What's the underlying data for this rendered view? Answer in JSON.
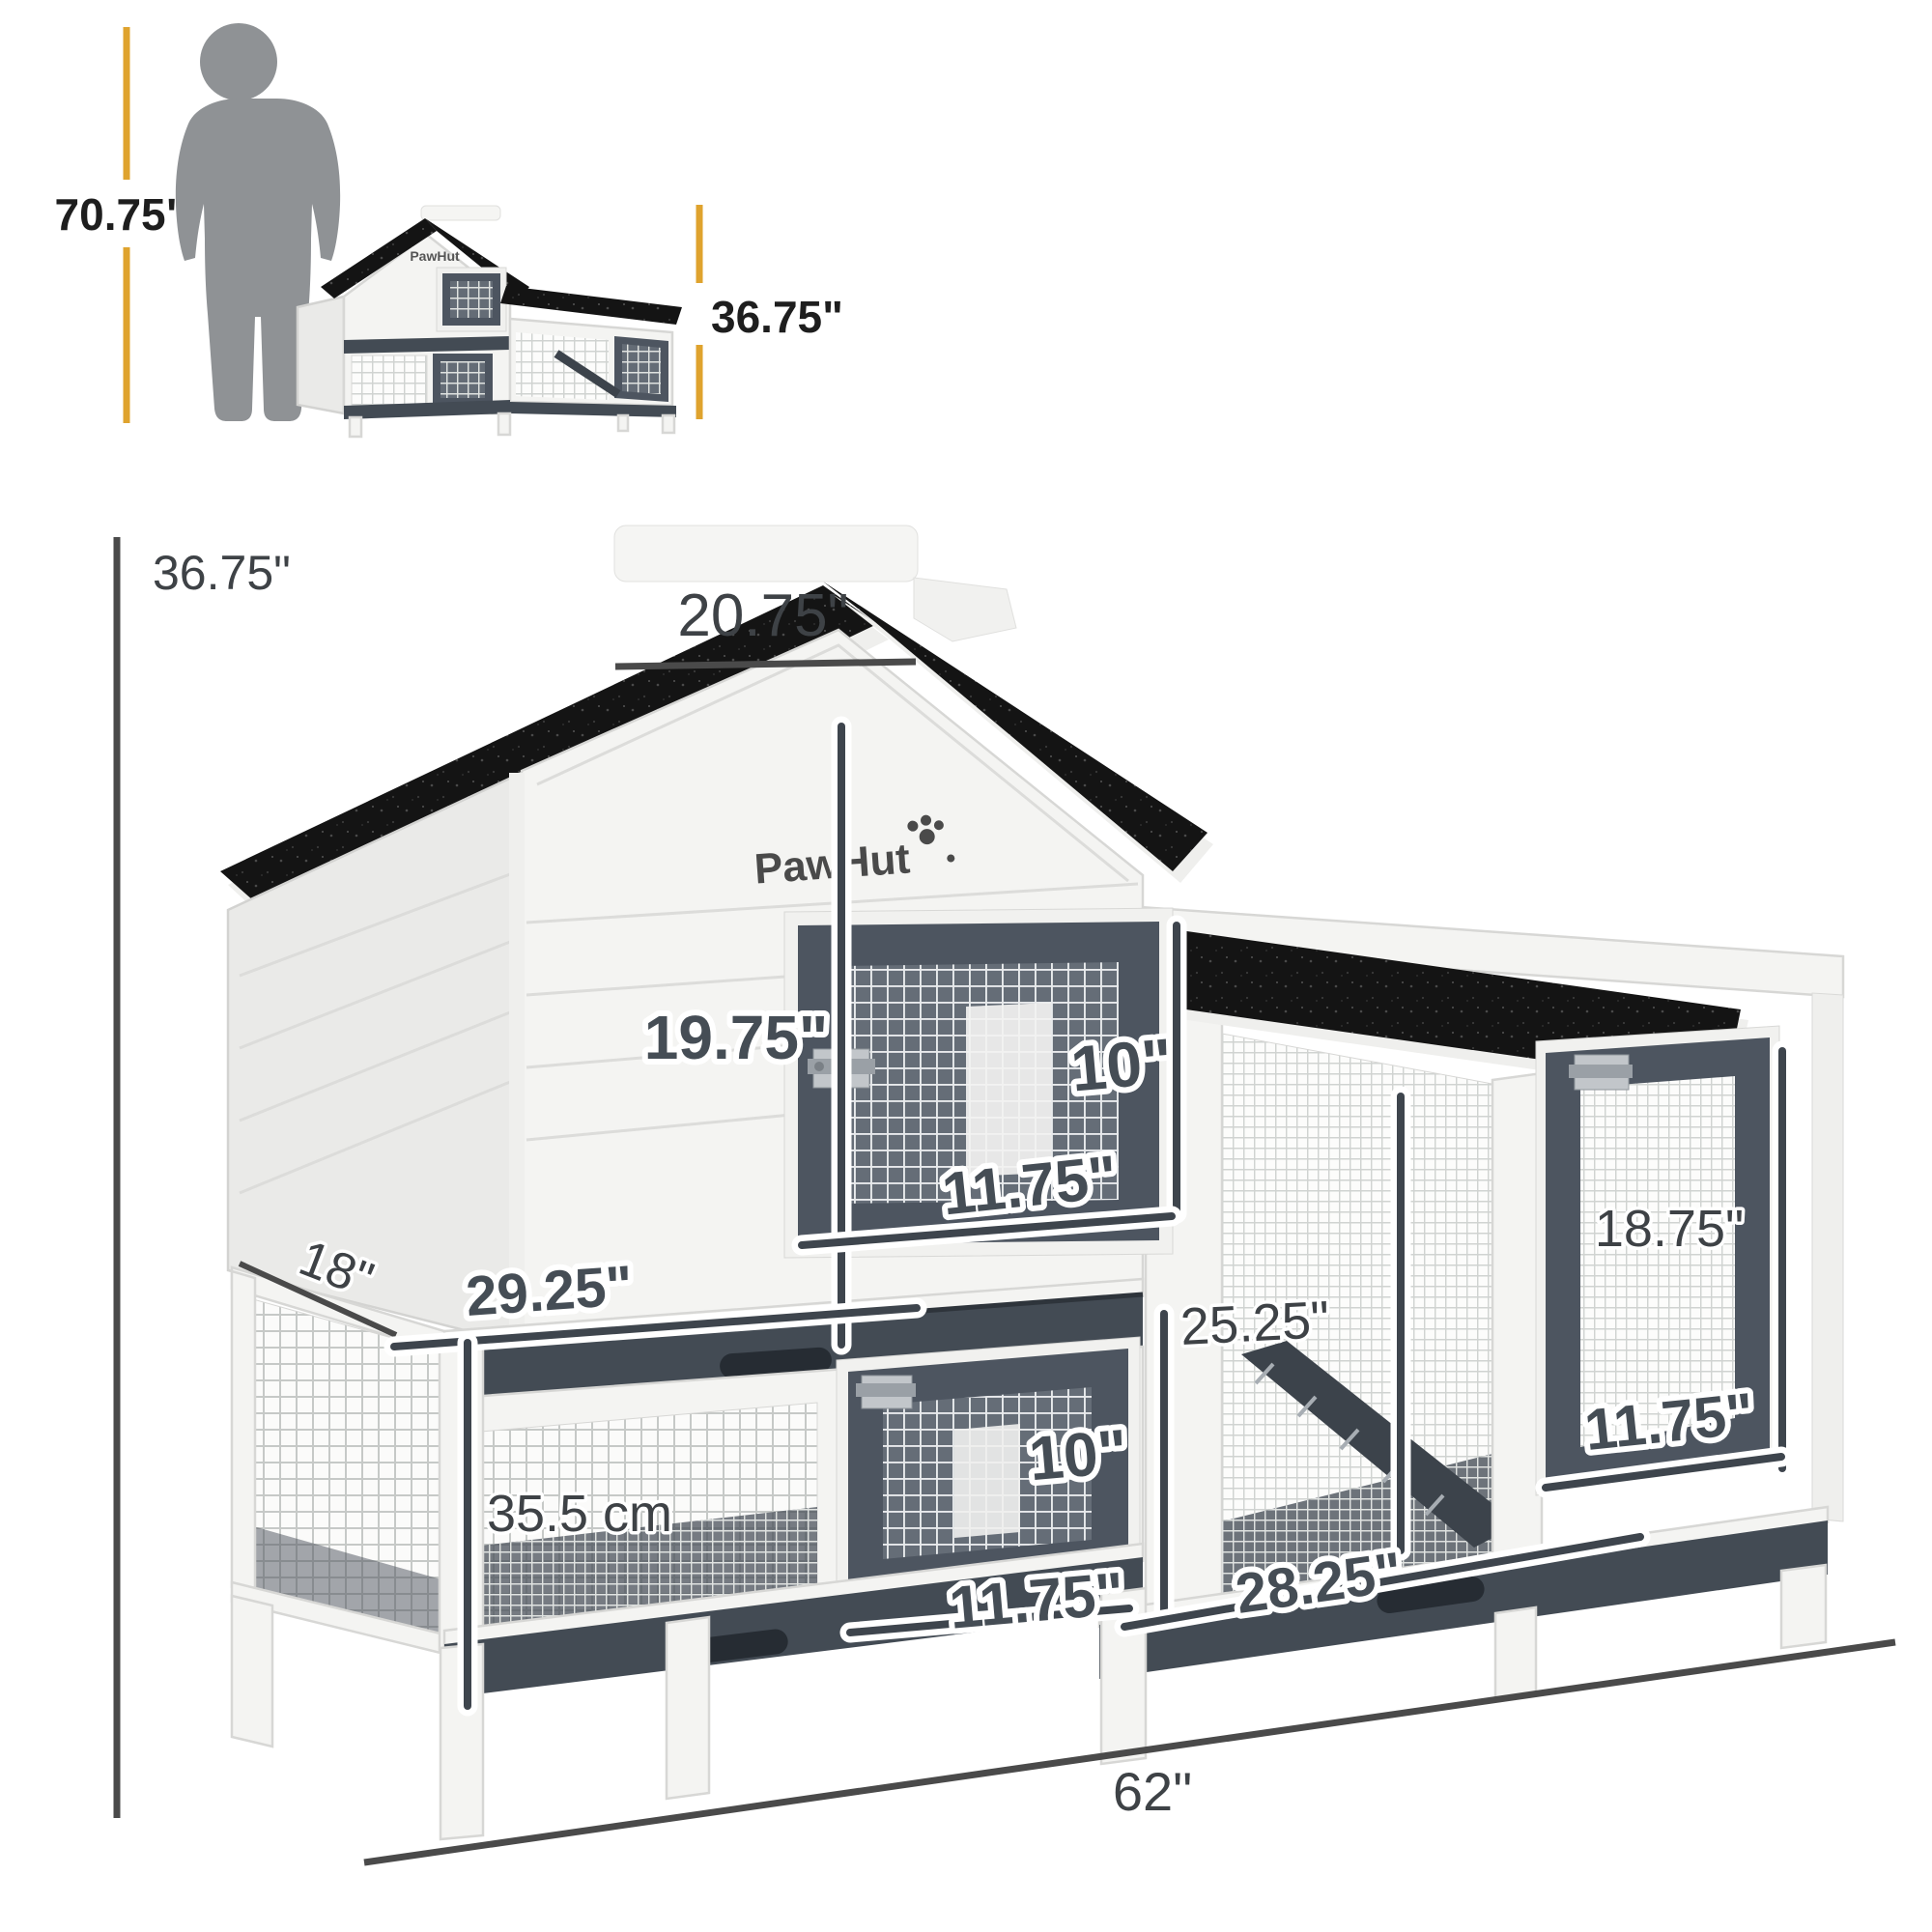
{
  "title": "Rabbit hutch dimension diagram",
  "brand": {
    "logo_text": "PawHut"
  },
  "scale_reference": {
    "person_height": "70.75\"",
    "hutch_height": "36.75\""
  },
  "dimensions": {
    "overall_height": "36.75\"",
    "roof_top_width": "20.75\"",
    "upper_level_height": "19.75\"",
    "upper_door_opening_height": "10\"",
    "upper_door_width": "11.75\"",
    "depth": "18\"",
    "main_house_width": "29.25\"",
    "run_interior_height": "25.25\"",
    "lower_level_height": "35.5 cm",
    "lower_door_opening_height": "10\"",
    "lower_door_width": "11.75\"",
    "run_opening_width": "28.25\"",
    "run_door_height": "18.75\"",
    "run_door_width": "11.75\"",
    "overall_width": "62\""
  },
  "colors": {
    "accent_yellow": "#DFA32E",
    "roof_black": "#141414",
    "frame_dark_gray": "#4D5560",
    "tray_gray": "#434B54",
    "body_white": "#F4F4F2",
    "silhouette_gray": "#8F9295",
    "dimension_line": "#4A4A4A"
  }
}
